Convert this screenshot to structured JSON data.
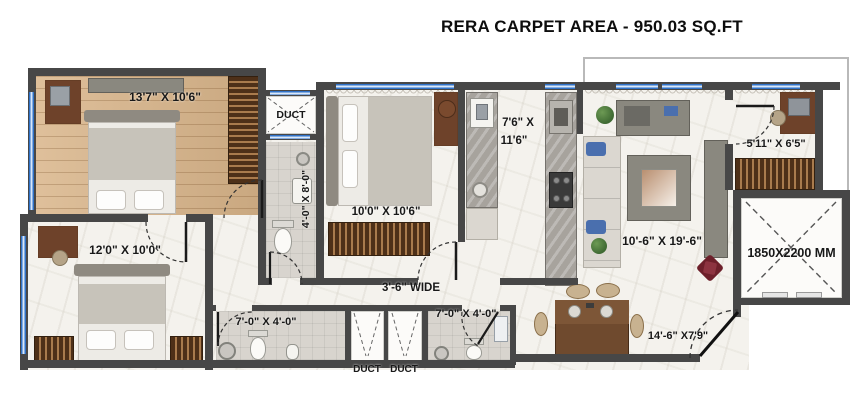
{
  "title": "RERA CARPET AREA - 950.03 SQ.FT",
  "plan": {
    "rooms": {
      "bedroom_top_left": "13'7\" X 10'6\"",
      "duct_top": "DUCT",
      "bath_attached": "4'-0\" X 8'-0\"",
      "bedroom_middle": "10'0\" X 10'6\"",
      "kitchen_line1": "7'6\" X",
      "kitchen_line2": "11'6\"",
      "living": "10'-6\" X 19'-6\"",
      "study": "5'11\" X 6'5\"",
      "lift": "1850X2200 MM",
      "bedroom_bottom_left": "12'0\" X 10'0\"",
      "passage": "3'-6\" WIDE",
      "bath_common_left": "7'-0\" X 4'-0\"",
      "bath_common_right": "7'-0\" X 4'-0\"",
      "dining": "14'-6\" X7'9\"",
      "duct_bottom_left": "DUCT",
      "duct_bottom_right": "DUCT"
    },
    "colors": {
      "wall": "#474747",
      "wood_floor": "#d9b58a",
      "marble_floor": "#f4f2ed",
      "bath_floor": "#d8d4ce",
      "window_blue": "#2f72c8",
      "furniture_brown": "#6e422a",
      "label_text": "#181818"
    }
  }
}
